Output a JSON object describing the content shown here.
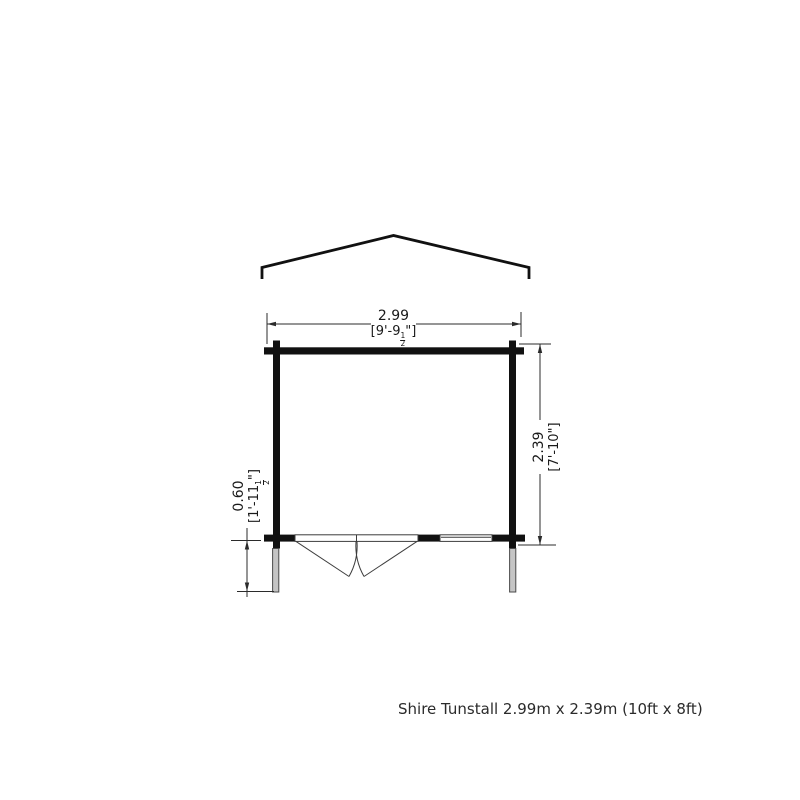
{
  "caption": "Shire Tunstall 2.99m x 2.39m (10ft x 8ft)",
  "drawing_labels": {
    "width": {
      "metric": "2.99",
      "imperial_prefix": "[9'-9",
      "fraction_numerator": "1",
      "fraction_denominator": "2",
      "imperial_suffix": "\"]"
    },
    "depth": {
      "metric": "2.39",
      "imperial": "[7'-10\"]"
    },
    "overhang": {
      "metric": "0.60",
      "imperial_prefix": "[1'-11",
      "fraction_numerator": "1",
      "fraction_denominator": "2",
      "imperial_suffix": "\"]"
    }
  },
  "colors": {
    "wall": "#111111",
    "line": "#2b2b2b",
    "thin_line": "#3d3d3d",
    "post_fill": "#c5c5c5",
    "background": "#ffffff"
  }
}
